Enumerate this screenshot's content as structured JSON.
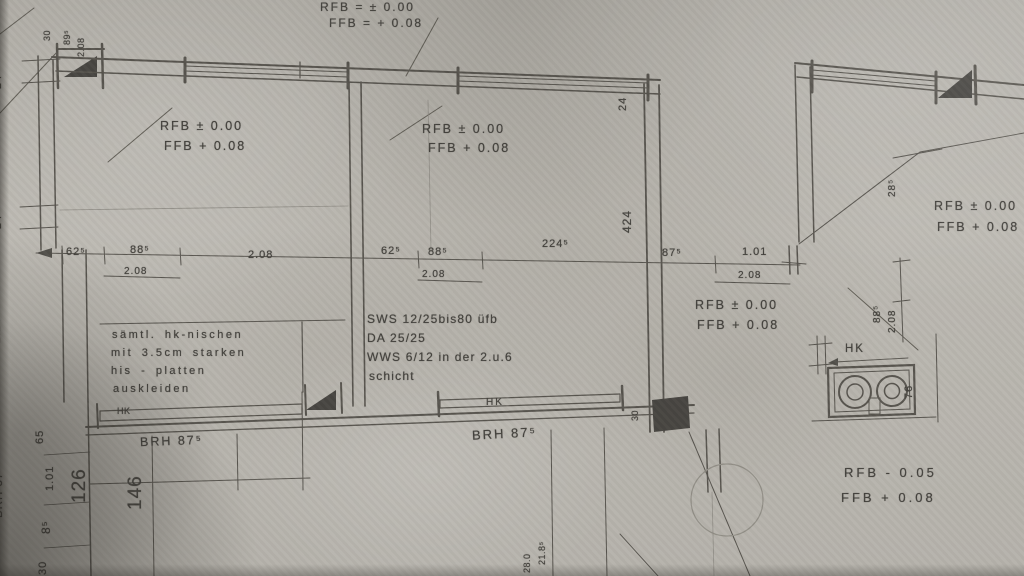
{
  "elevations": {
    "header": {
      "l1": "RFB = ± 0.00",
      "l2": "FFB = + 0.08"
    },
    "room_left": {
      "l1": "RFB ± 0.00",
      "l2": "FFB + 0.08"
    },
    "room_middle": {
      "l1": "RFB ± 0.00",
      "l2": "FFB + 0.08"
    },
    "room_right": {
      "l1": "RFB ± 0.00",
      "l2": "FFB + 0.08"
    },
    "hall": {
      "l1": "RFB ± 0.00",
      "l2": "FFB + 0.08"
    },
    "bottom_right": {
      "l1": "RFB - 0.05",
      "l2": "FFB + 0.08"
    }
  },
  "notes": {
    "hk_niche": {
      "l1": "sämtl. hk-nischen",
      "l2": "mit 3.5cm starken",
      "l3": "his - platten",
      "l4": "auskleiden"
    },
    "construction": {
      "l1": "SWS 12/25bis80 üfb",
      "l2": "DA 25/25",
      "l3": "WWS 6/12 in der 2.u.6",
      "l4": "schicht"
    }
  },
  "radiators": {
    "left": "HK",
    "middle": "HK",
    "right": "HK"
  },
  "sills": {
    "left_rot": "BRH 87⁵",
    "left": "BRH 87⁵",
    "middle": "BRH 87⁵"
  },
  "dimensions": {
    "left_24a": "24",
    "left_180": "180",
    "left_24b": "24",
    "left_214": "2.14",
    "tl_30": "30",
    "tl_89": "89⁵",
    "tl_208": "2.08",
    "rowA_62": "62⁵",
    "rowA_88": "88⁵",
    "rowA_208a": "2.08",
    "rowA_208b": "2.08",
    "rowB_62": "62⁵",
    "rowB_88": "88⁵",
    "rowB_208": "2.08",
    "rowB_224": "224⁵",
    "hall_87": "87⁵",
    "hall_101": "1.01",
    "hall_208": "2.08",
    "wall_24": "24",
    "wall_424": "424",
    "right_28": "28⁵",
    "right_88": "88⁵",
    "right_208": "2.08",
    "right_76": "76",
    "bl_65": "65",
    "bl_101": "1.01",
    "bl_126": "126",
    "bl_8": "8⁵",
    "bl_146": "146",
    "bl_30": "30",
    "bm_280": "28.0",
    "bm_218": "21.8⁵",
    "bm_30": "30"
  }
}
